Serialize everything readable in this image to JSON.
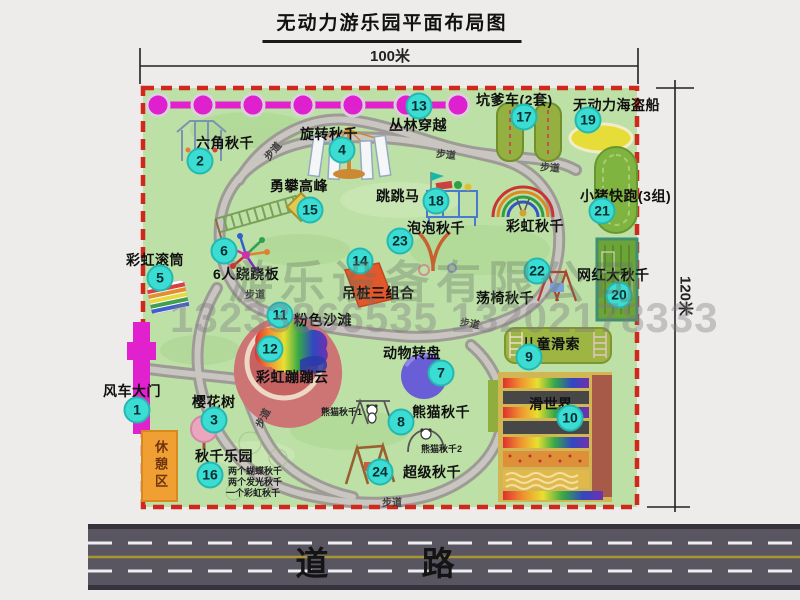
{
  "title": "无动力游乐园平面布局图",
  "dimensions": {
    "width_label": "100米",
    "height_label": "120米"
  },
  "watermark": {
    "company": "游乐设备有限公司",
    "phone": "13233866535 13202178333"
  },
  "road": {
    "label": "道 路"
  },
  "colors": {
    "map_green": "#bce0a5",
    "border_red": "#d0281c",
    "chain_magenta": "#e121ce",
    "badge_cyan": "#3bdcd2",
    "road_gray": "#595662",
    "rest_orange": "#f0a032"
  },
  "map": {
    "walkway_label": "步道",
    "rest_area_label": "休憩区",
    "walkways": [
      {
        "x": 262,
        "y": 143,
        "r": -50
      },
      {
        "x": 436,
        "y": 146,
        "r": 6
      },
      {
        "x": 540,
        "y": 159,
        "r": 4
      },
      {
        "x": 245,
        "y": 286,
        "r": 0
      },
      {
        "x": 252,
        "y": 410,
        "r": -62
      },
      {
        "x": 460,
        "y": 315,
        "r": 10
      },
      {
        "x": 382,
        "y": 494,
        "r": 0
      }
    ],
    "attractions": [
      {
        "id": "windmill-gate",
        "num": 1,
        "label": "风车大门",
        "lx": 103,
        "ly": 381,
        "bx": 137,
        "by": 410
      },
      {
        "id": "hexagon-swing",
        "num": 2,
        "label": "六角秋千",
        "lx": 196,
        "ly": 133,
        "bx": 200,
        "by": 161
      },
      {
        "id": "cherry-tree",
        "num": 3,
        "label": "樱花树",
        "lx": 192,
        "ly": 392,
        "bx": 214,
        "by": 420
      },
      {
        "id": "rotating-swing",
        "num": 4,
        "label": "旋转秋千",
        "lx": 300,
        "ly": 124,
        "bx": 342,
        "by": 150
      },
      {
        "id": "rainbow-roller",
        "num": 5,
        "label": "彩虹滚筒",
        "lx": 126,
        "ly": 250,
        "bx": 160,
        "by": 278
      },
      {
        "id": "six-seesaw",
        "num": 6,
        "label": "6人跷跷板",
        "lx": 213,
        "ly": 264,
        "bx": 224,
        "by": 251
      },
      {
        "id": "animal-turntable",
        "num": 7,
        "label": "动物转盘",
        "lx": 383,
        "ly": 343,
        "bx": 441,
        "by": 373
      },
      {
        "id": "panda-swing",
        "num": 8,
        "label": "熊猫秋千",
        "lx": 412,
        "ly": 402,
        "bx": 401,
        "by": 422,
        "sub": [
          {
            "t": "熊猫秋千1",
            "x": 321,
            "y": 405
          },
          {
            "t": "熊猫秋千2",
            "x": 421,
            "y": 442
          }
        ]
      },
      {
        "id": "kids-zipline",
        "num": 9,
        "label": "儿童滑索",
        "lx": 522,
        "ly": 334,
        "bx": 529,
        "by": 357
      },
      {
        "id": "slide-world",
        "num": 10,
        "label": "滑世界",
        "lx": 529,
        "ly": 394,
        "bx": 570,
        "by": 418
      },
      {
        "id": "pink-beach",
        "num": 11,
        "label": "粉色沙滩",
        "lx": 294,
        "ly": 310,
        "bx": 280,
        "by": 315
      },
      {
        "id": "rainbow-cloud",
        "num": 12,
        "label": "彩虹蹦蹦云",
        "lx": 256,
        "ly": 367,
        "bx": 270,
        "by": 349
      },
      {
        "id": "jungle-crossing",
        "num": 13,
        "label": "丛林穿越",
        "lx": 389,
        "ly": 115,
        "bx": 419,
        "by": 106
      },
      {
        "id": "hanging-piles",
        "num": 14,
        "label": "吊桩三组合",
        "lx": 342,
        "ly": 283,
        "bx": 360,
        "by": 261
      },
      {
        "id": "climb-peak",
        "num": 15,
        "label": "勇攀高峰",
        "lx": 270,
        "ly": 176,
        "bx": 310,
        "by": 210
      },
      {
        "id": "swing-paradise",
        "num": 16,
        "label": "秋千乐园",
        "lx": 195,
        "ly": 446,
        "bx": 210,
        "by": 475,
        "sub": [
          {
            "t": "两个蝴蝶秋千",
            "x": 228,
            "y": 464
          },
          {
            "t": "两个发光秋千",
            "x": 228,
            "y": 475
          },
          {
            "t": "一个彩虹秋千",
            "x": 226,
            "y": 486
          }
        ]
      },
      {
        "id": "pit-cars",
        "num": 17,
        "label": "坑爹车(2套)",
        "lx": 476,
        "ly": 90,
        "bx": 524,
        "by": 117
      },
      {
        "id": "jump-horse",
        "num": 18,
        "label": "跳跳马",
        "lx": 376,
        "ly": 186,
        "bx": 436,
        "by": 201
      },
      {
        "id": "pirate-ship",
        "num": 19,
        "label": "无动力海盗船",
        "lx": 573,
        "ly": 95,
        "bx": 588,
        "by": 120
      },
      {
        "id": "net-big-swing",
        "num": 20,
        "label": "网红大秋千",
        "lx": 577,
        "ly": 265,
        "bx": 619,
        "by": 295
      },
      {
        "id": "pig-run",
        "num": 21,
        "label": "小猪快跑(3组)",
        "lx": 580,
        "ly": 186,
        "bx": 602,
        "by": 211
      },
      {
        "id": "chair-swing",
        "num": 22,
        "label": "荡椅秋千",
        "lx": 476,
        "ly": 288,
        "bx": 537,
        "by": 271
      },
      {
        "id": "bubble-swing",
        "num": 23,
        "label": "泡泡秋千",
        "lx": 407,
        "ly": 218,
        "bx": 400,
        "by": 241
      },
      {
        "id": "super-swing",
        "num": 24,
        "label": "超级秋千",
        "lx": 403,
        "ly": 462,
        "bx": 380,
        "by": 472
      },
      {
        "id": "rainbow-swing",
        "num": null,
        "label": "彩虹秋千",
        "lx": 506,
        "ly": 216
      }
    ]
  }
}
